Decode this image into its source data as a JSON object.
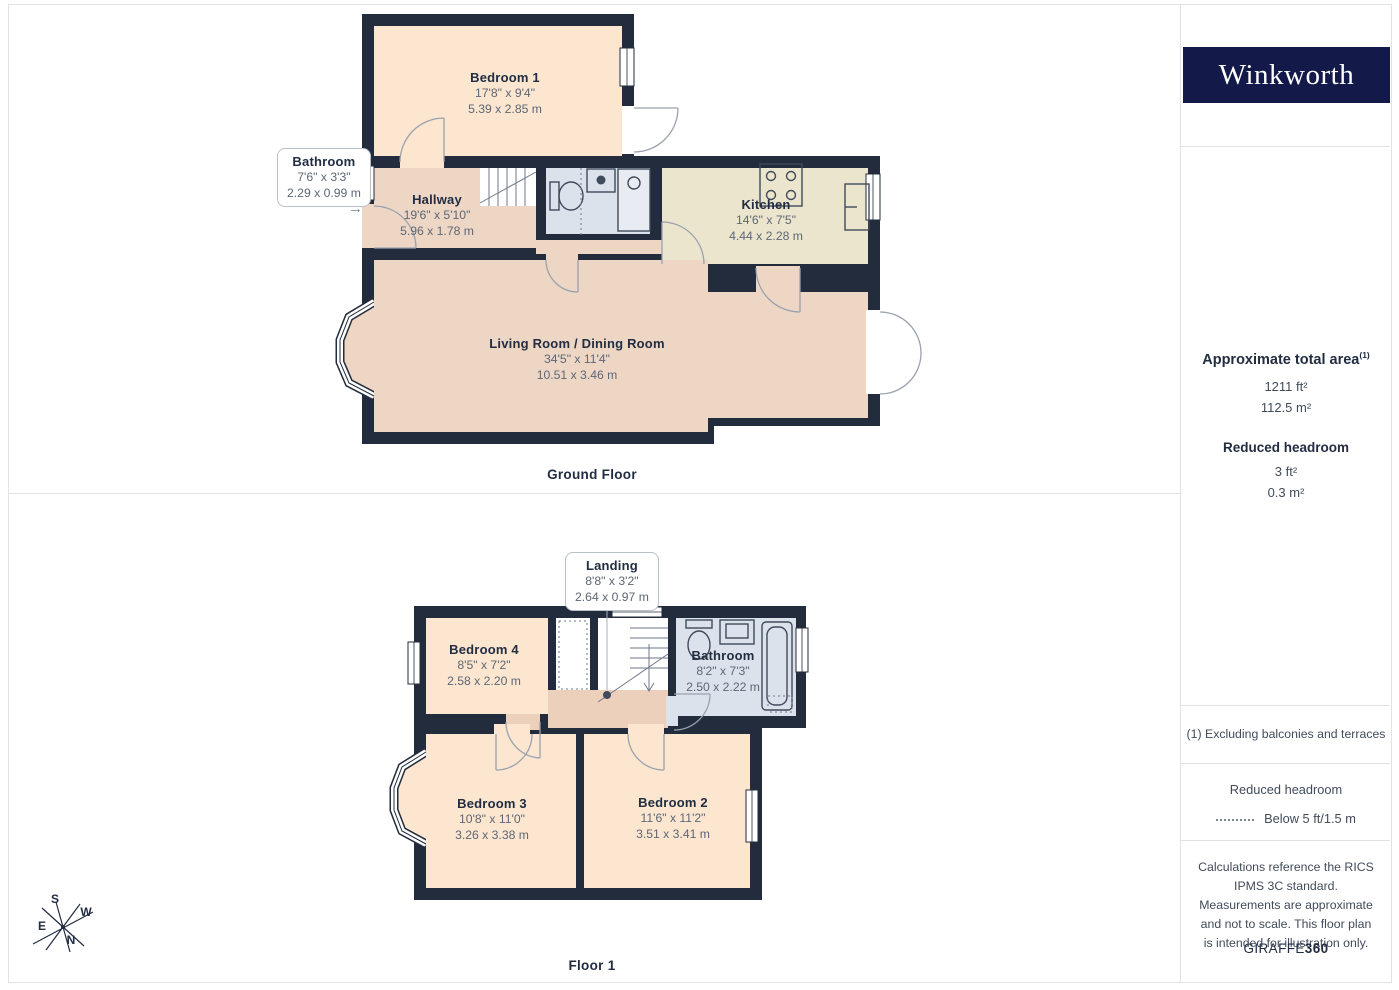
{
  "brand": {
    "logo_text": "Winkworth"
  },
  "colors": {
    "logo_navy": "#131a4a",
    "wall": "#222c3c",
    "room_peach": "#fce6d0",
    "room_pink": "#eed6c5",
    "room_khaki": "#ece5ce",
    "room_blue": "#dce2ec",
    "text_dark": "#222d42",
    "text_grey": "#5d6775"
  },
  "floors": [
    {
      "title": "Ground Floor",
      "rooms": [
        {
          "name": "Bedroom 1",
          "dims_ft": "17'8\" x 9'4\"",
          "dims_m": "5.39 x 2.85 m"
        },
        {
          "name": "Hallway",
          "dims_ft": "19'6\" x 5'10\"",
          "dims_m": "5.96 x 1.78 m"
        },
        {
          "name": "Kitchen",
          "dims_ft": "14'6\" x 7'5\"",
          "dims_m": "4.44 x 2.28 m"
        },
        {
          "name": "Living Room / Dining Room",
          "dims_ft": "34'5\" x 11'4\"",
          "dims_m": "10.51 x 3.46 m"
        }
      ],
      "callout": {
        "name": "Bathroom",
        "dims_ft": "7'6\" x 3'3\"",
        "dims_m": "2.29 x 0.99 m"
      }
    },
    {
      "title": "Floor 1",
      "rooms": [
        {
          "name": "Bedroom 4",
          "dims_ft": "8'5\" x 7'2\"",
          "dims_m": "2.58 x 2.20 m"
        },
        {
          "name": "Bathroom",
          "dims_ft": "8'2\" x 7'3\"",
          "dims_m": "2.50 x 2.22 m"
        },
        {
          "name": "Bedroom 3",
          "dims_ft": "10'8\" x 11'0\"",
          "dims_m": "3.26 x 3.38 m"
        },
        {
          "name": "Bedroom 2",
          "dims_ft": "11'6\" x 11'2\"",
          "dims_m": "3.51 x 3.41 m"
        }
      ],
      "callout": {
        "name": "Landing",
        "dims_ft": "8'8\" x 3'2\"",
        "dims_m": "2.64 x 0.97 m"
      }
    }
  ],
  "sidebar": {
    "area": {
      "heading": "Approximate total area",
      "superscript": "(1)",
      "value_ft": "1211 ft²",
      "value_m": "112.5 m²"
    },
    "reduced_headroom": {
      "heading": "Reduced headroom",
      "value_ft": "3 ft²",
      "value_m": "0.3 m²"
    },
    "footnote": "(1) Excluding balconies and terraces",
    "legend": {
      "heading": "Reduced headroom",
      "label": "Below 5 ft/1.5 m"
    },
    "disclaimer": "Calculations reference the RICS IPMS 3C standard. Measurements are approximate and not to scale. This floor plan is intended for illustration only.",
    "credit": {
      "normal": "GIRAFFE",
      "bold": "360"
    }
  },
  "compass": {
    "n": "N",
    "s": "S",
    "e": "E",
    "w": "W"
  }
}
